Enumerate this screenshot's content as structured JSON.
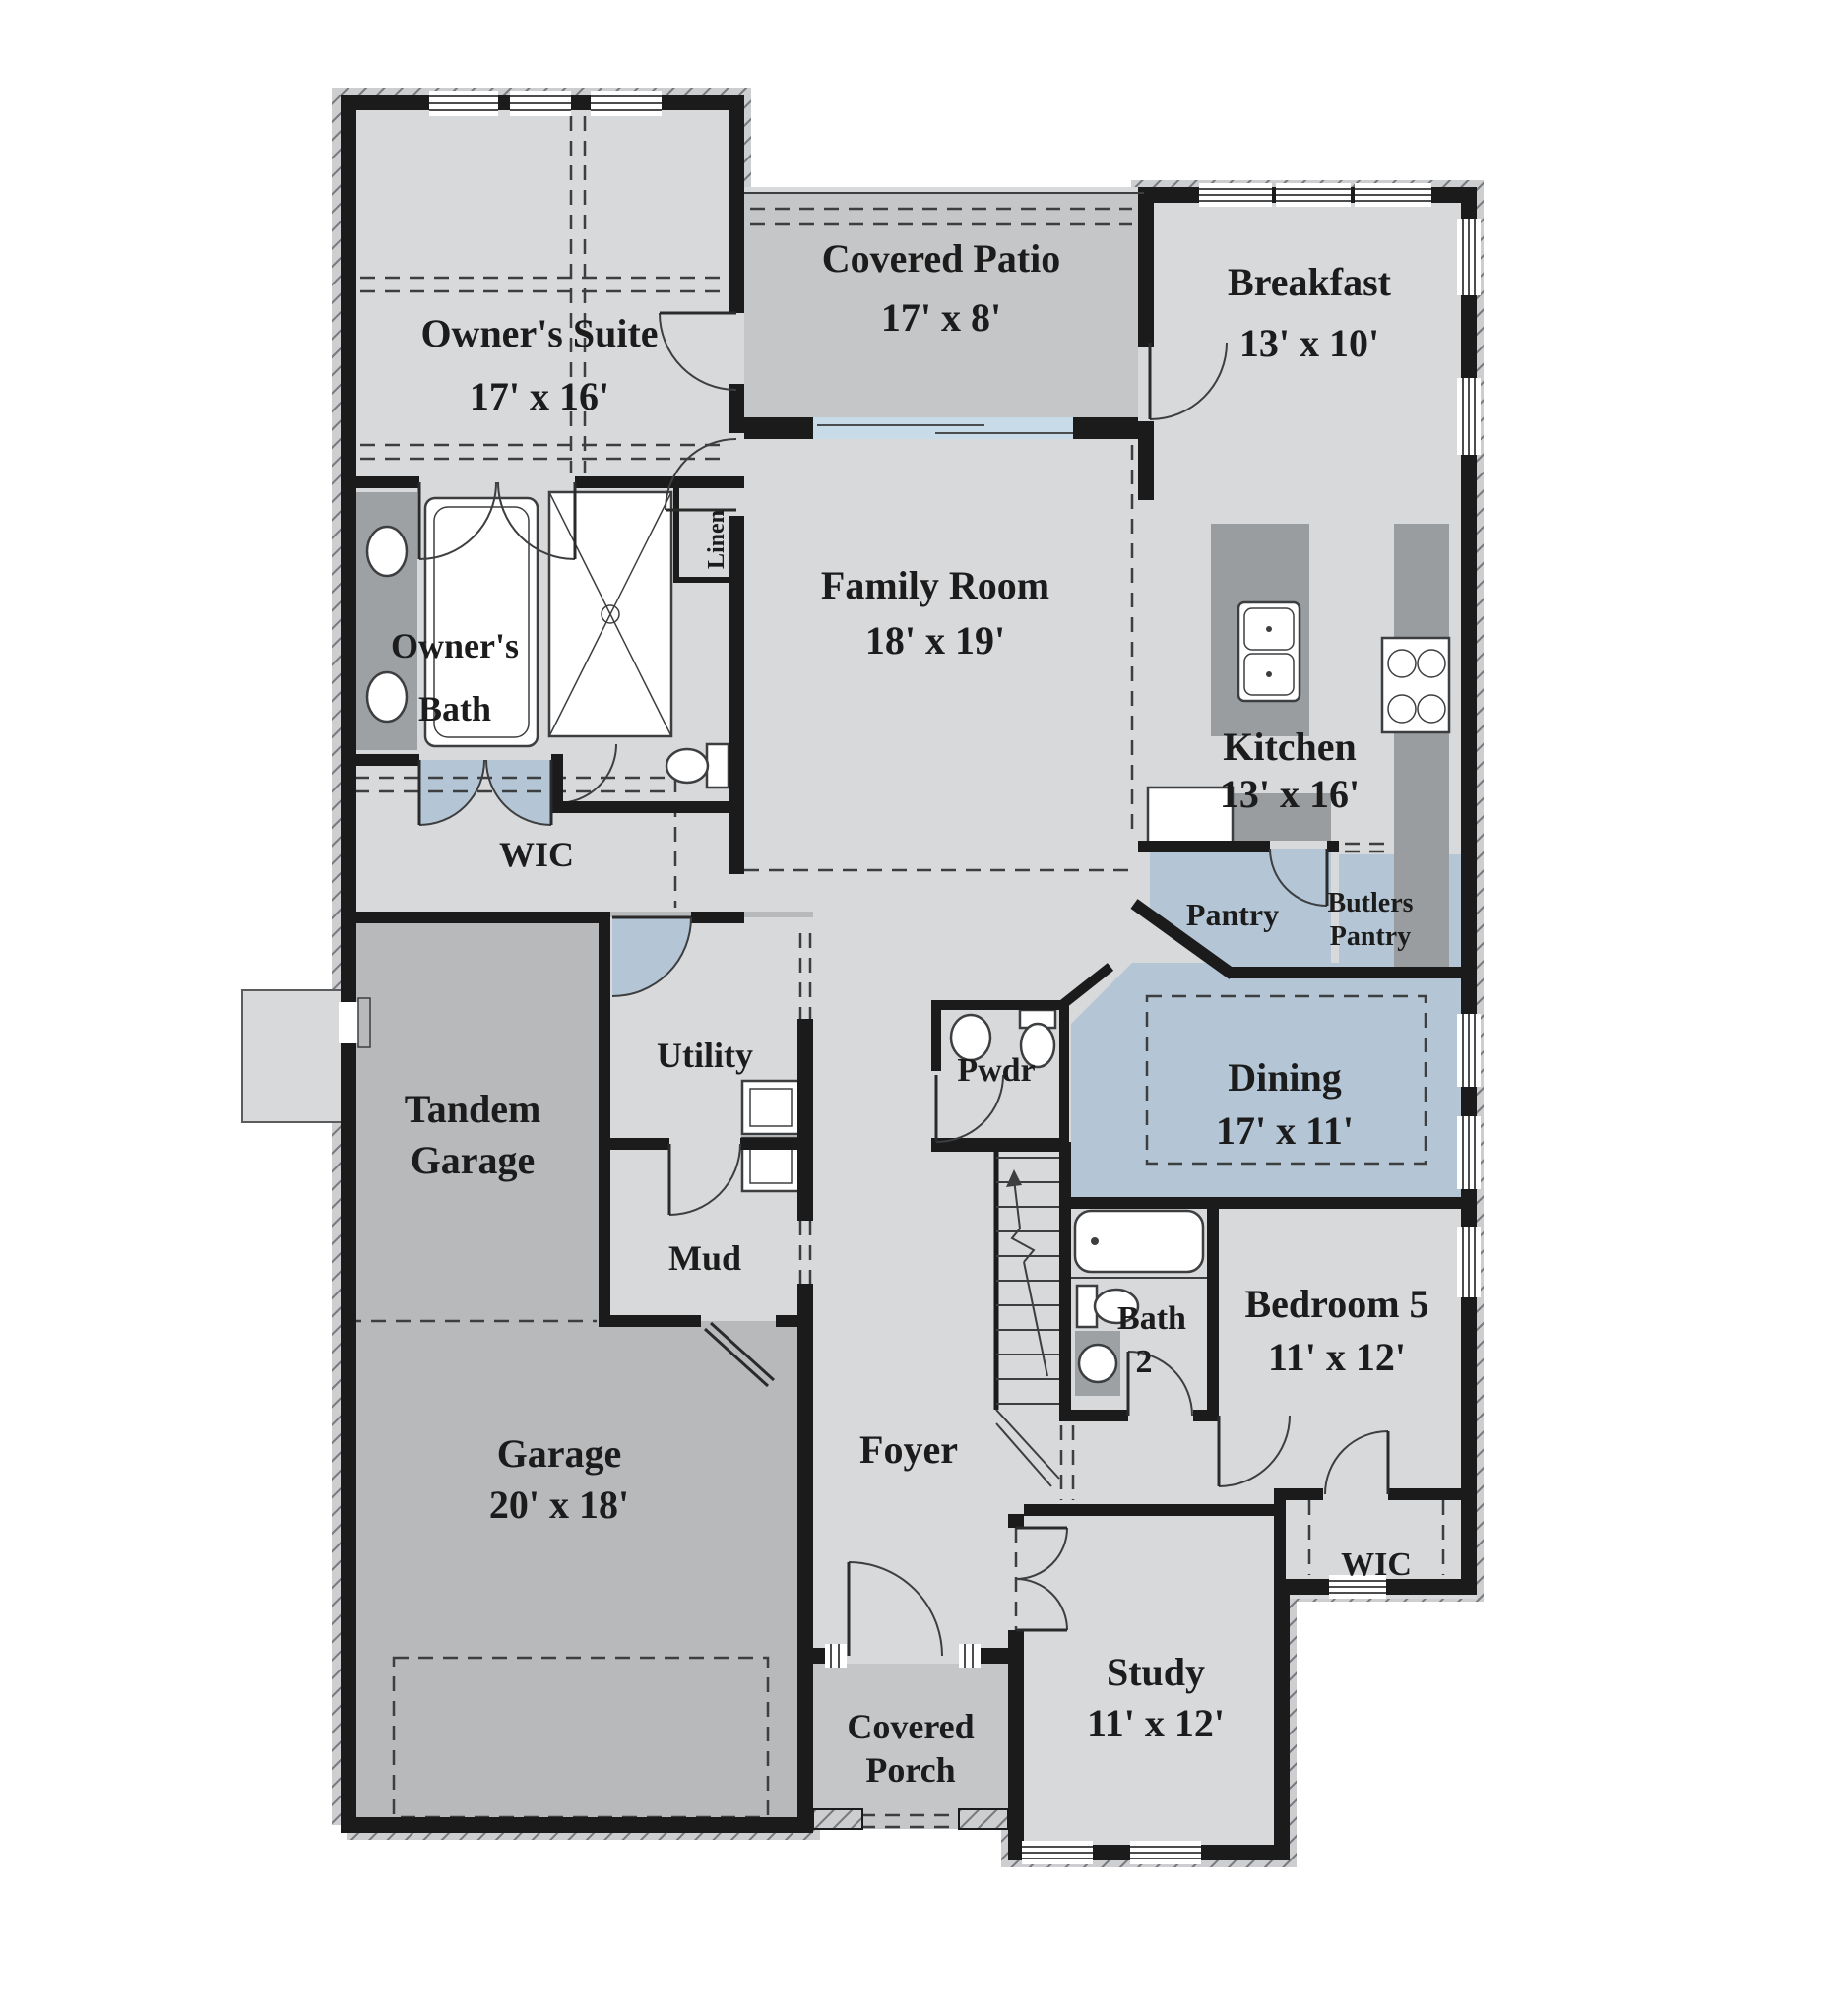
{
  "rooms": {
    "owners_suite": {
      "lines": [
        "Owner's Suite",
        "17' x 16'"
      ]
    },
    "covered_patio": {
      "lines": [
        "Covered Patio",
        "17' x 8'"
      ]
    },
    "breakfast": {
      "lines": [
        "Breakfast",
        "13' x 10'"
      ]
    },
    "family_room": {
      "lines": [
        "Family Room",
        "18' x 19'"
      ]
    },
    "owners_bath": {
      "lines": [
        "Owner's",
        "Bath"
      ]
    },
    "linen": {
      "lines": [
        "Linen"
      ]
    },
    "wic_owners": {
      "lines": [
        "WIC"
      ]
    },
    "kitchen": {
      "lines": [
        "Kitchen",
        "13' x 16'"
      ]
    },
    "pantry": {
      "lines": [
        "Pantry"
      ]
    },
    "butlers_pantry": {
      "lines": [
        "Butlers",
        "Pantry"
      ]
    },
    "dining": {
      "lines": [
        "Dining",
        "17' x 11'"
      ]
    },
    "pwdr": {
      "lines": [
        "Pwdr"
      ]
    },
    "tandem_garage": {
      "lines": [
        "Tandem",
        "Garage"
      ]
    },
    "utility": {
      "lines": [
        "Utility"
      ]
    },
    "mud": {
      "lines": [
        "Mud"
      ]
    },
    "garage": {
      "lines": [
        "Garage",
        "20' x 18'"
      ]
    },
    "foyer": {
      "lines": [
        "Foyer"
      ]
    },
    "bath_2": {
      "lines": [
        "Bath",
        "2"
      ]
    },
    "bedroom_5": {
      "lines": [
        "Bedroom 5",
        "11' x 12'"
      ]
    },
    "wic_bedroom5": {
      "lines": [
        "WIC"
      ]
    },
    "study": {
      "lines": [
        "Study",
        "11' x 12'"
      ]
    },
    "covered_porch": {
      "lines": [
        "Covered",
        "Porch"
      ]
    }
  },
  "colors": {
    "room_fill": "#d8d9db",
    "garage_fill": "#b7b9bb",
    "patio_fill": "#c5c6c8",
    "accent_blue": "#b4c6d5",
    "glass_blue": "#c7dbe9",
    "counter_gray": "#9a9da0",
    "wall_black": "#1b1b1b",
    "hatch_gray": "#77797c"
  }
}
